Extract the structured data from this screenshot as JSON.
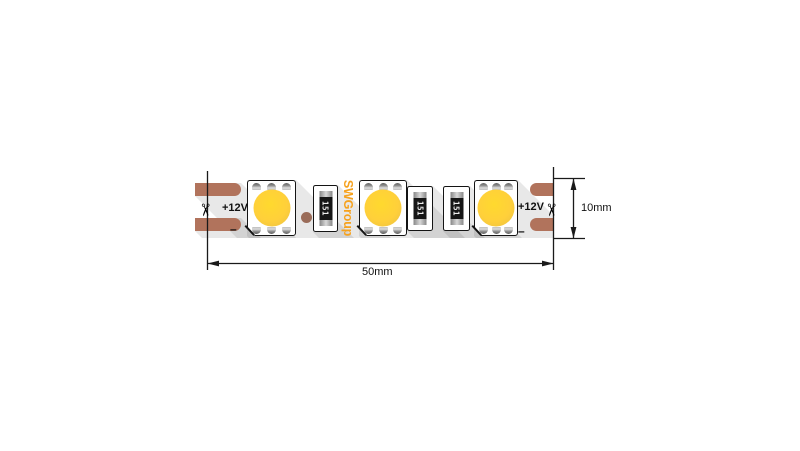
{
  "strip": {
    "brand_logo": "SWGroup",
    "left_terminal": {
      "plus": "+12V",
      "minus": "–"
    },
    "right_terminal": {
      "plus": "+12V",
      "minus": "–"
    },
    "resistors": [
      {
        "code": "151"
      },
      {
        "code": "151"
      },
      {
        "code": "151"
      }
    ],
    "led_count": 3
  },
  "dimensions": {
    "width": "50mm",
    "height": "10mm"
  },
  "icons": {
    "scissors": "✂"
  },
  "colors": {
    "copper_pad": "#B1735C",
    "led_yellow": "#FFD23B",
    "brand_orange": "#F6A21E",
    "line": "#1A1A1A"
  }
}
